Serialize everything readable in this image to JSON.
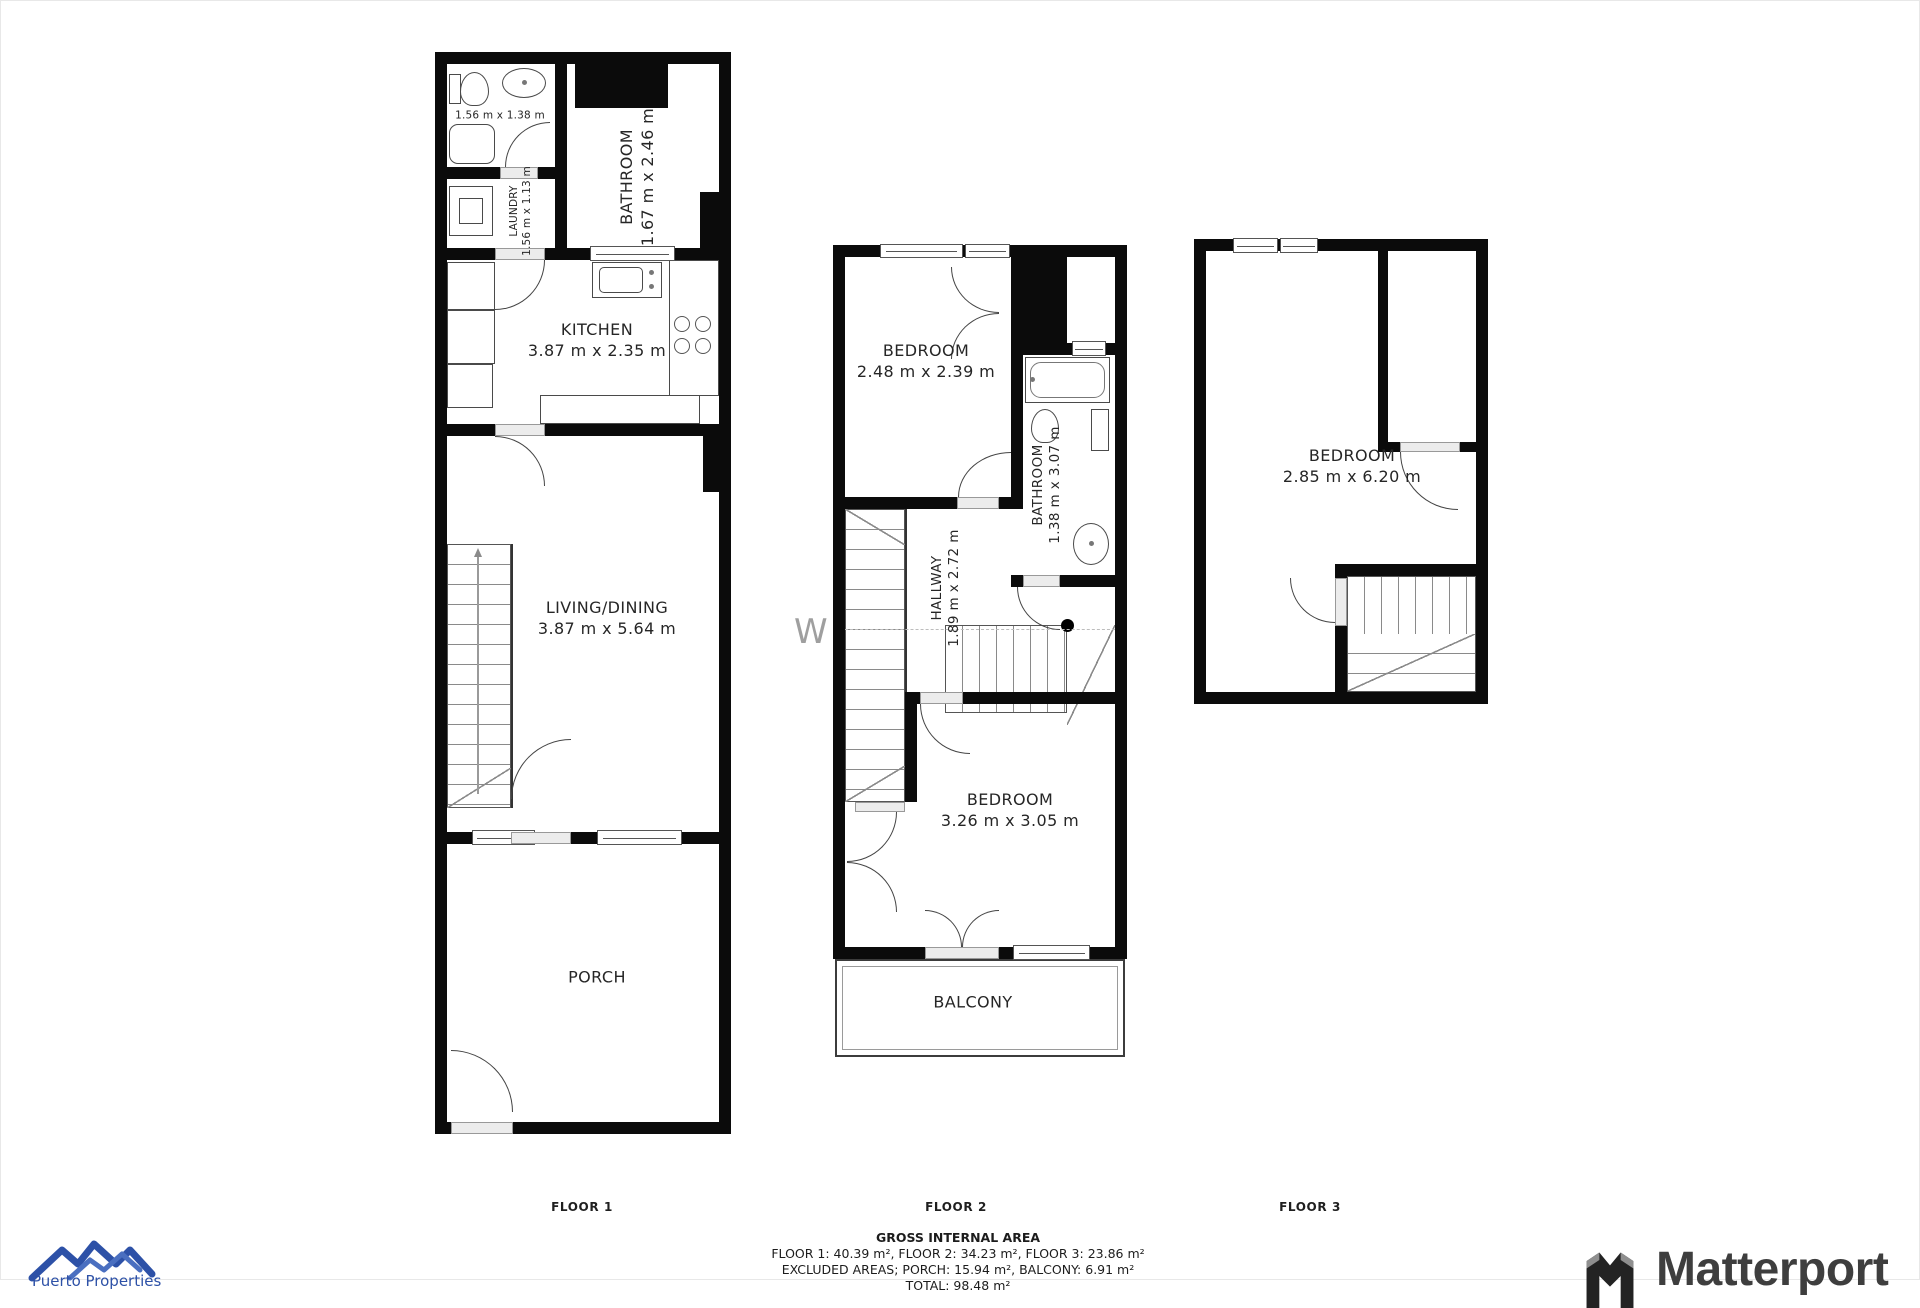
{
  "plan": {
    "floor1": {
      "label": "FLOOR 1",
      "wc_dims": "1.56 m x 1.38 m",
      "laundry": "LAUNDRY",
      "laundry_dims": "1.56 m x 1.13 m",
      "bathroom": "BATHROOM",
      "bathroom_dims": "1.67 m x 2.46 m",
      "kitchen": "KITCHEN",
      "kitchen_dims": "3.87 m x 2.35 m",
      "living": "LIVING/DINING",
      "living_dims": "3.87 m x 5.64 m",
      "porch": "PORCH"
    },
    "floor2": {
      "label": "FLOOR 2",
      "bedroom1": "BEDROOM",
      "bedroom1_dims": "2.48 m x 2.39 m",
      "bathroom": "BATHROOM",
      "bathroom_dims": "1.38 m x 3.07 m",
      "hallway": "HALLWAY",
      "hallway_dims": "1.89 m x 2.72 m",
      "bedroom2": "BEDROOM",
      "bedroom2_dims": "3.26 m x 3.05 m",
      "balcony": "BALCONY"
    },
    "floor3": {
      "label": "FLOOR 3",
      "bedroom": "BEDROOM",
      "bedroom_dims": "2.85 m x 6.20 m"
    }
  },
  "summary": {
    "title": "GROSS INTERNAL AREA",
    "line1": "FLOOR 1: 40.39 m², FLOOR 2: 34.23 m², FLOOR 3: 23.86 m²",
    "line2": "EXCLUDED AREAS; PORCH: 15.94 m², BALCONY: 6.91 m²",
    "line3": "TOTAL: 98.48 m²"
  },
  "branding": {
    "agency_name": "Puerto Properties",
    "matterport": "Matterport"
  },
  "watermark": "W",
  "colors": {
    "wall": "#0b0b0b",
    "accent_blue": "#2d51a7",
    "matterport_gray": "#3e3e3e"
  }
}
